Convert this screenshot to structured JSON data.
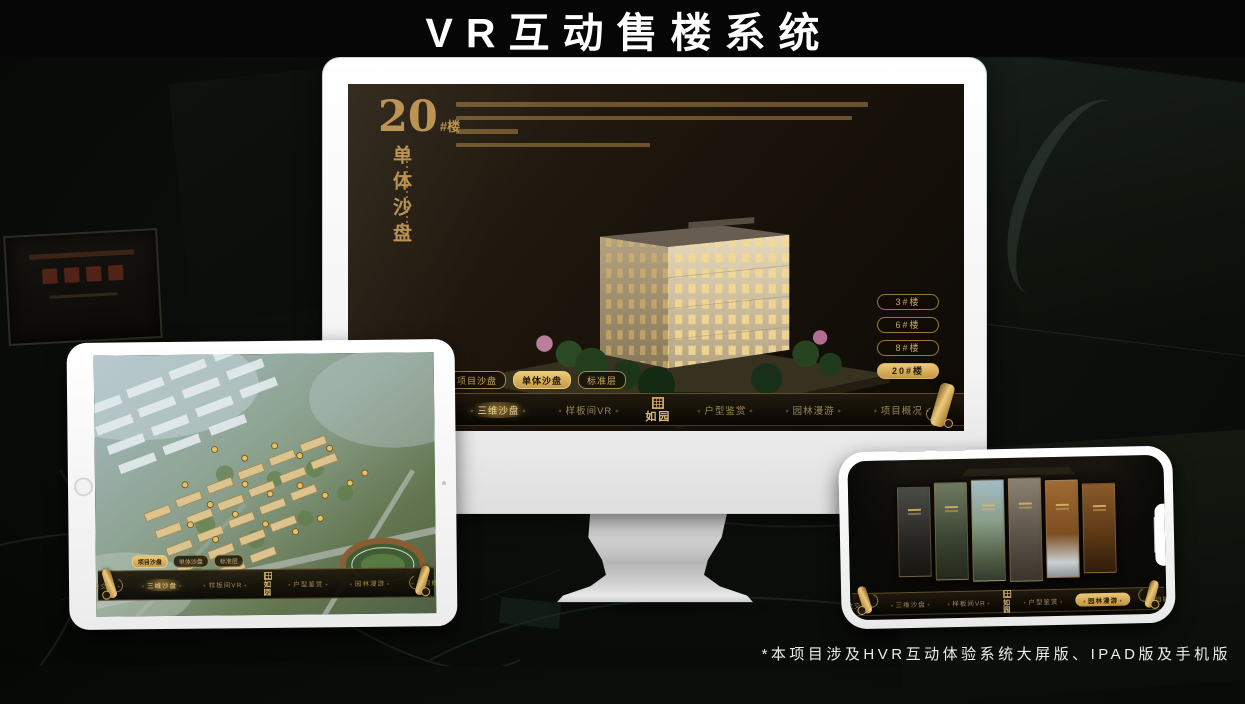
{
  "page": {
    "title": "VR互动售楼系统",
    "footnote": "*本项目涉及HVR互动体验系统大屏版、IPAD版及手机版"
  },
  "colors": {
    "gold": "#c9a55e",
    "gold_bright": "#ecc878",
    "screen_dark": "#1a130b",
    "device_body": "#ffffff"
  },
  "icons": {
    "scroll": "scroll-ornament-icon",
    "seal": "ruyuan-seal-icon"
  },
  "logo": {
    "name": "如园"
  },
  "nav": {
    "items": [
      "区位交通",
      "三维沙盘",
      "样板间VR",
      "户型鉴赏",
      "园林漫游",
      "项目概况"
    ]
  },
  "sub_tabs": [
    "项目沙盘",
    "单体沙盘",
    "标准层"
  ],
  "monitor": {
    "hero": {
      "number": "20",
      "suffix": "#楼",
      "title": "单体沙盘"
    },
    "floor_buttons": [
      "3#楼",
      "6#楼",
      "8#楼",
      "20#楼"
    ],
    "active_floor": "20#楼",
    "active_sub_tab": "单体沙盘",
    "active_nav_item": "三维沙盘"
  },
  "tablet": {
    "active_sub_tab": "项目沙盘",
    "active_nav_item": "三维沙盘"
  },
  "phone": {
    "active_nav_item": "园林漫游"
  }
}
